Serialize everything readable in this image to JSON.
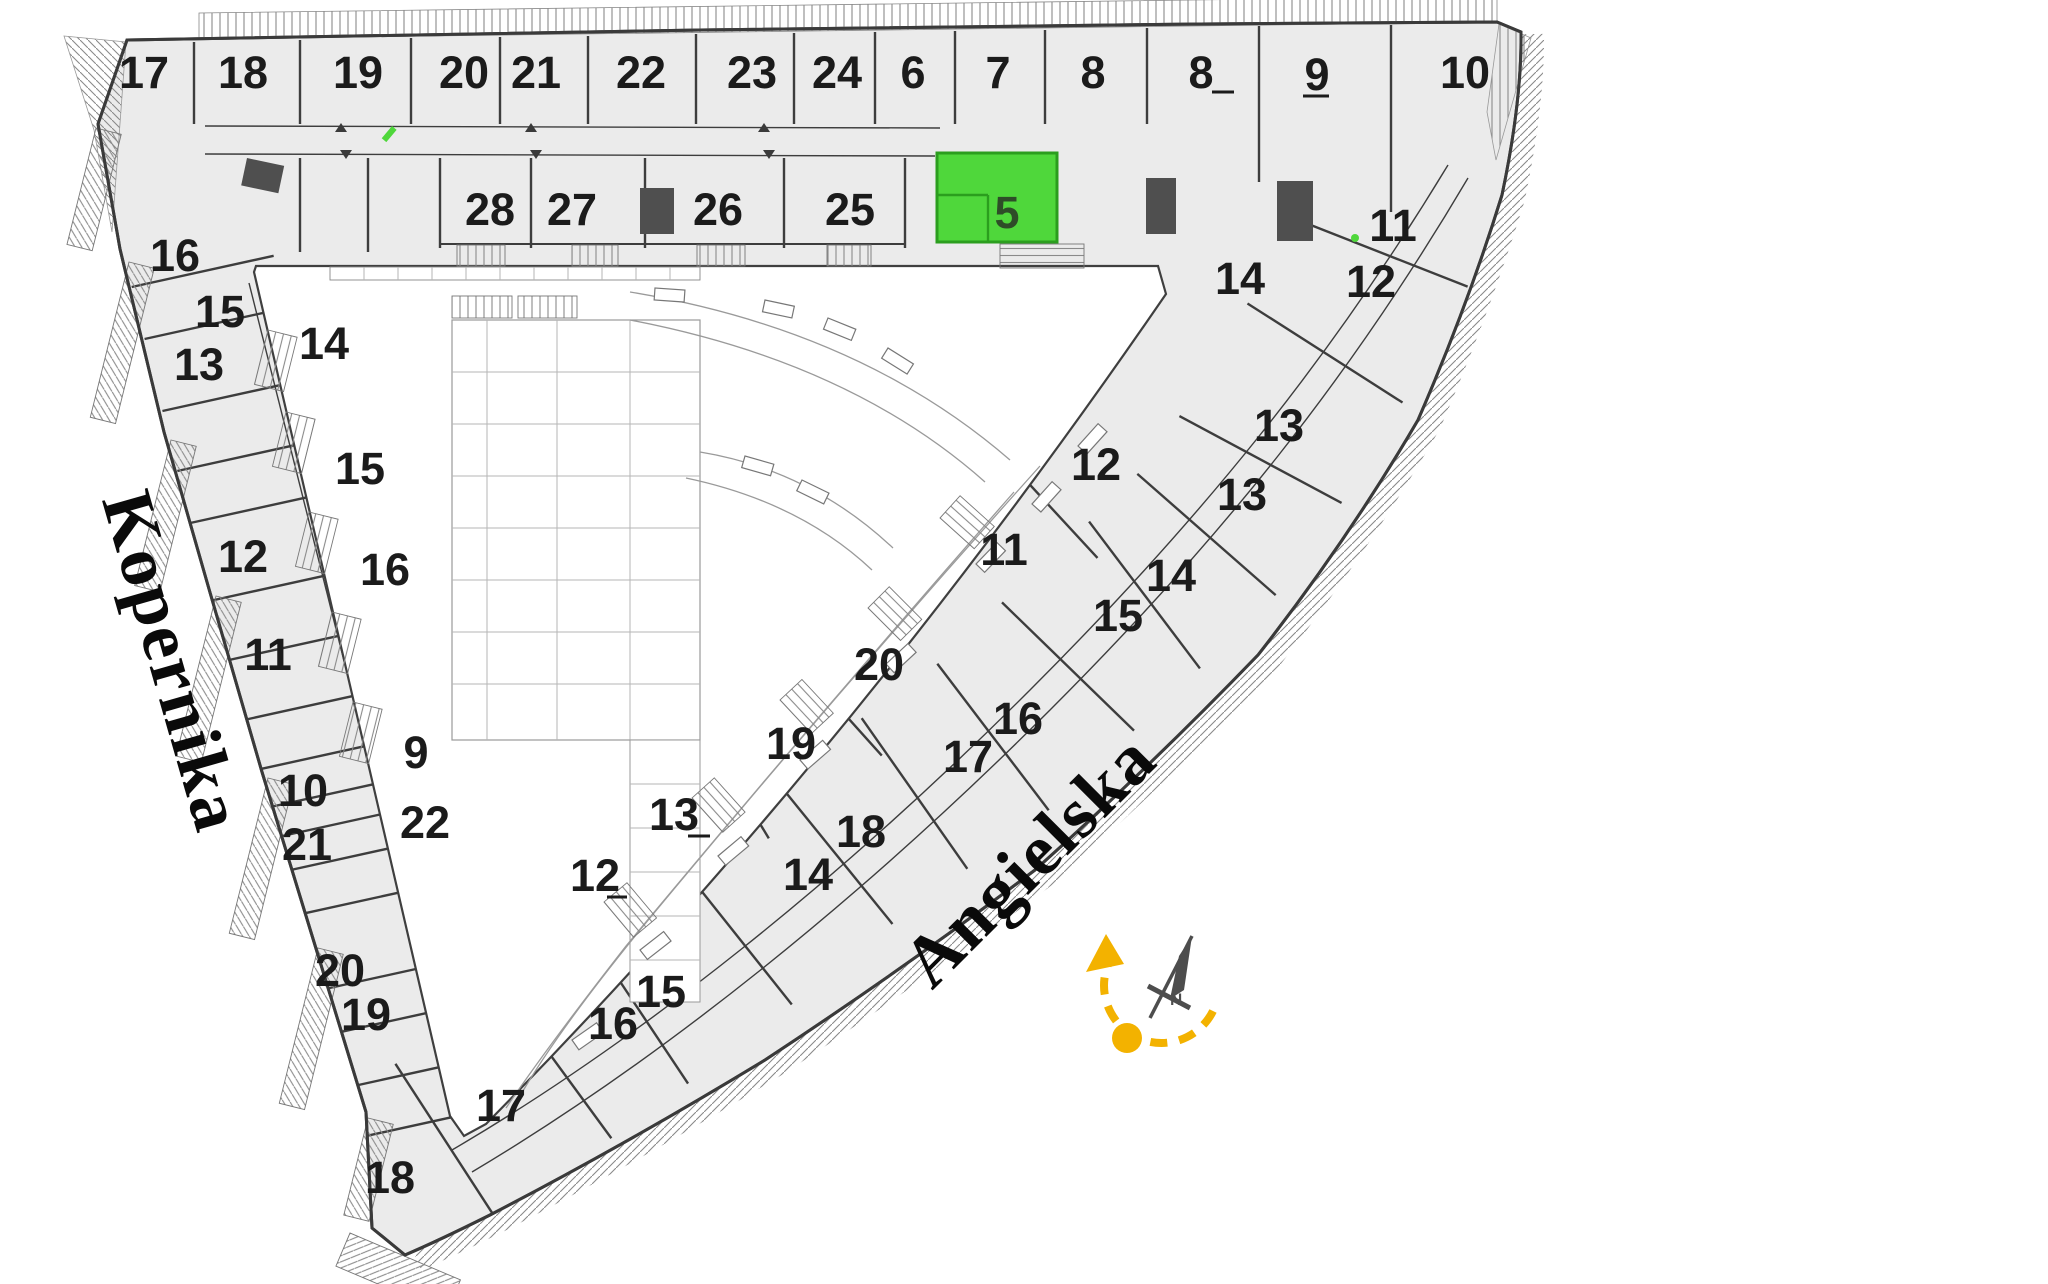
{
  "canvas": {
    "width": 2048,
    "height": 1284,
    "background": "#ffffff"
  },
  "streets": [
    {
      "id": "kopernika",
      "name": "Kopernika",
      "x": 150,
      "y": 668,
      "rotation": 74
    },
    {
      "id": "angielska",
      "name": "Angielska",
      "x": 1046,
      "y": 877,
      "rotation": -45
    }
  ],
  "highlighted_unit": {
    "label": "5",
    "label_x": 1007,
    "label_y": 228,
    "rect": {
      "x": 937,
      "y": 153,
      "width": 120,
      "height": 89
    },
    "fill": "#4fd73b",
    "stroke": "#2b9e1e",
    "label_color": "#2e4d28"
  },
  "units": [
    {
      "n": "17",
      "x": 144,
      "y": 72
    },
    {
      "n": "18",
      "x": 243,
      "y": 72
    },
    {
      "n": "19",
      "x": 358,
      "y": 72
    },
    {
      "n": "20",
      "x": 464,
      "y": 72
    },
    {
      "n": "21",
      "x": 536,
      "y": 72
    },
    {
      "n": "22",
      "x": 641,
      "y": 72
    },
    {
      "n": "23",
      "x": 752,
      "y": 72
    },
    {
      "n": "24",
      "x": 837,
      "y": 72
    },
    {
      "n": "6",
      "x": 913,
      "y": 72
    },
    {
      "n": "7",
      "x": 998,
      "y": 72
    },
    {
      "n": "8",
      "x": 1093,
      "y": 72
    },
    {
      "n": "8",
      "x": 1201,
      "y": 72
    },
    {
      "n": "9",
      "x": 1317,
      "y": 74
    },
    {
      "n": "10",
      "x": 1465,
      "y": 72
    },
    {
      "n": "28",
      "x": 490,
      "y": 209
    },
    {
      "n": "27",
      "x": 572,
      "y": 209
    },
    {
      "n": "26",
      "x": 718,
      "y": 209
    },
    {
      "n": "25",
      "x": 850,
      "y": 209
    },
    {
      "n": "14",
      "x": 1240,
      "y": 278
    },
    {
      "n": "11",
      "x": 1393,
      "y": 225
    },
    {
      "n": "12",
      "x": 1371,
      "y": 281
    },
    {
      "n": "16",
      "x": 175,
      "y": 255
    },
    {
      "n": "15",
      "x": 220,
      "y": 311
    },
    {
      "n": "13",
      "x": 199,
      "y": 364
    },
    {
      "n": "14",
      "x": 324,
      "y": 343
    },
    {
      "n": "15",
      "x": 360,
      "y": 468
    },
    {
      "n": "12",
      "x": 243,
      "y": 556
    },
    {
      "n": "16",
      "x": 385,
      "y": 569
    },
    {
      "n": "11",
      "x": 268,
      "y": 654
    },
    {
      "n": "9",
      "x": 416,
      "y": 752
    },
    {
      "n": "10",
      "x": 303,
      "y": 790
    },
    {
      "n": "22",
      "x": 425,
      "y": 822
    },
    {
      "n": "21",
      "x": 307,
      "y": 844
    },
    {
      "n": "20",
      "x": 340,
      "y": 970
    },
    {
      "n": "19",
      "x": 366,
      "y": 1014
    },
    {
      "n": "18",
      "x": 390,
      "y": 1177
    },
    {
      "n": "17",
      "x": 501,
      "y": 1105
    },
    {
      "n": "16",
      "x": 613,
      "y": 1023
    },
    {
      "n": "15",
      "x": 661,
      "y": 991
    },
    {
      "n": "12",
      "x": 595,
      "y": 875
    },
    {
      "n": "13",
      "x": 674,
      "y": 814
    },
    {
      "n": "14",
      "x": 808,
      "y": 874
    },
    {
      "n": "18",
      "x": 861,
      "y": 831
    },
    {
      "n": "19",
      "x": 791,
      "y": 743
    },
    {
      "n": "20",
      "x": 879,
      "y": 664
    },
    {
      "n": "17",
      "x": 968,
      "y": 756
    },
    {
      "n": "16",
      "x": 1018,
      "y": 718
    },
    {
      "n": "15",
      "x": 1118,
      "y": 615
    },
    {
      "n": "14",
      "x": 1171,
      "y": 575
    },
    {
      "n": "11",
      "x": 1004,
      "y": 549
    },
    {
      "n": "12",
      "x": 1096,
      "y": 464
    },
    {
      "n": "13",
      "x": 1242,
      "y": 494
    },
    {
      "n": "13",
      "x": 1279,
      "y": 425
    }
  ],
  "compass": {
    "north_label": "N",
    "arc_color": "#f3b200",
    "needle_color": "#4d4d4d"
  },
  "colors": {
    "building_fill": "#ebebeb",
    "wall": "#3a3a3a",
    "number": "#1b1b1b",
    "highlight_green": "#4fd73b",
    "hatch": "#8a8a8a",
    "street_text": "#0a0a0a"
  }
}
